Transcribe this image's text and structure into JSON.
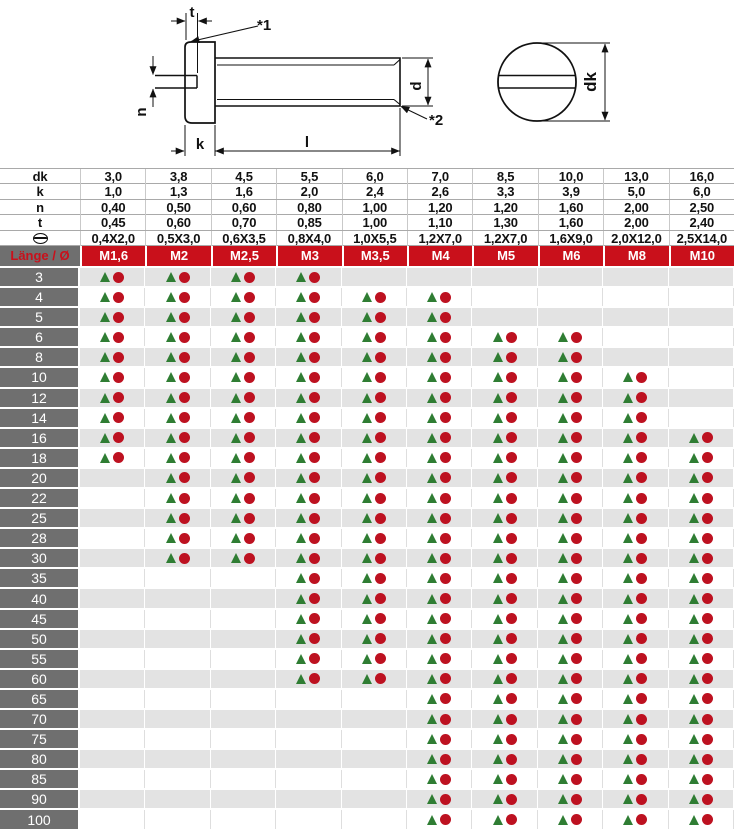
{
  "colors": {
    "header_red": "#c9101b",
    "label_gray": "#6f6f6f",
    "row_gray": "#e3e3e3",
    "triangle_green": "#2f7d33",
    "circle_red": "#bd1120"
  },
  "diagram": {
    "labels": {
      "t": "t",
      "ref1": "*1",
      "n": "n",
      "d": "d",
      "ref2": "*2",
      "k": "k",
      "l": "l",
      "dk": "dk"
    }
  },
  "dims": {
    "rows": [
      {
        "label": "dk",
        "values": [
          "3,0",
          "3,8",
          "4,5",
          "5,5",
          "6,0",
          "7,0",
          "8,5",
          "10,0",
          "13,0",
          "16,0"
        ]
      },
      {
        "label": "k",
        "values": [
          "1,0",
          "1,3",
          "1,6",
          "2,0",
          "2,4",
          "2,6",
          "3,3",
          "3,9",
          "5,0",
          "6,0"
        ]
      },
      {
        "label": "n",
        "values": [
          "0,40",
          "0,50",
          "0,60",
          "0,80",
          "1,00",
          "1,20",
          "1,20",
          "1,60",
          "2,00",
          "2,50"
        ]
      },
      {
        "label": "t",
        "values": [
          "0,45",
          "0,60",
          "0,70",
          "0,85",
          "1,00",
          "1,10",
          "1,30",
          "1,60",
          "2,00",
          "2,40"
        ]
      },
      {
        "label": "⊖",
        "icon": "slot-drive-icon",
        "values": [
          "0,4X2,0",
          "0,5X3,0",
          "0,6X3,5",
          "0,8X4,0",
          "1,0X5,5",
          "1,2X7,0",
          "1,2X7,0",
          "1,6X9,0",
          "2,0X12,0",
          "2,5X14,0"
        ]
      }
    ]
  },
  "table": {
    "corner": "Länge / Ø",
    "columns": [
      "M1,6",
      "M2",
      "M2,5",
      "M3",
      "M3,5",
      "M4",
      "M5",
      "M6",
      "M8",
      "M10"
    ],
    "marker_meaning": {
      "triangle": "green-triangle-marker",
      "circle": "red-circle-marker"
    },
    "rows": [
      {
        "length": "3",
        "available": [
          1,
          1,
          1,
          1,
          0,
          0,
          0,
          0,
          0,
          0
        ]
      },
      {
        "length": "4",
        "available": [
          1,
          1,
          1,
          1,
          1,
          1,
          0,
          0,
          0,
          0
        ]
      },
      {
        "length": "5",
        "available": [
          1,
          1,
          1,
          1,
          1,
          1,
          0,
          0,
          0,
          0
        ]
      },
      {
        "length": "6",
        "available": [
          1,
          1,
          1,
          1,
          1,
          1,
          1,
          1,
          0,
          0
        ]
      },
      {
        "length": "8",
        "available": [
          1,
          1,
          1,
          1,
          1,
          1,
          1,
          1,
          0,
          0
        ]
      },
      {
        "length": "10",
        "available": [
          1,
          1,
          1,
          1,
          1,
          1,
          1,
          1,
          1,
          0
        ]
      },
      {
        "length": "12",
        "available": [
          1,
          1,
          1,
          1,
          1,
          1,
          1,
          1,
          1,
          0
        ]
      },
      {
        "length": "14",
        "available": [
          1,
          1,
          1,
          1,
          1,
          1,
          1,
          1,
          1,
          0
        ]
      },
      {
        "length": "16",
        "available": [
          1,
          1,
          1,
          1,
          1,
          1,
          1,
          1,
          1,
          1
        ]
      },
      {
        "length": "18",
        "available": [
          1,
          1,
          1,
          1,
          1,
          1,
          1,
          1,
          1,
          1
        ]
      },
      {
        "length": "20",
        "available": [
          0,
          1,
          1,
          1,
          1,
          1,
          1,
          1,
          1,
          1
        ]
      },
      {
        "length": "22",
        "available": [
          0,
          1,
          1,
          1,
          1,
          1,
          1,
          1,
          1,
          1
        ]
      },
      {
        "length": "25",
        "available": [
          0,
          1,
          1,
          1,
          1,
          1,
          1,
          1,
          1,
          1
        ]
      },
      {
        "length": "28",
        "available": [
          0,
          1,
          1,
          1,
          1,
          1,
          1,
          1,
          1,
          1
        ]
      },
      {
        "length": "30",
        "available": [
          0,
          1,
          1,
          1,
          1,
          1,
          1,
          1,
          1,
          1
        ]
      },
      {
        "length": "35",
        "available": [
          0,
          0,
          0,
          1,
          1,
          1,
          1,
          1,
          1,
          1
        ]
      },
      {
        "length": "40",
        "available": [
          0,
          0,
          0,
          1,
          1,
          1,
          1,
          1,
          1,
          1
        ]
      },
      {
        "length": "45",
        "available": [
          0,
          0,
          0,
          1,
          1,
          1,
          1,
          1,
          1,
          1
        ]
      },
      {
        "length": "50",
        "available": [
          0,
          0,
          0,
          1,
          1,
          1,
          1,
          1,
          1,
          1
        ]
      },
      {
        "length": "55",
        "available": [
          0,
          0,
          0,
          1,
          1,
          1,
          1,
          1,
          1,
          1
        ]
      },
      {
        "length": "60",
        "available": [
          0,
          0,
          0,
          1,
          1,
          1,
          1,
          1,
          1,
          1
        ]
      },
      {
        "length": "65",
        "available": [
          0,
          0,
          0,
          0,
          0,
          1,
          1,
          1,
          1,
          1
        ]
      },
      {
        "length": "70",
        "available": [
          0,
          0,
          0,
          0,
          0,
          1,
          1,
          1,
          1,
          1
        ]
      },
      {
        "length": "75",
        "available": [
          0,
          0,
          0,
          0,
          0,
          1,
          1,
          1,
          1,
          1
        ]
      },
      {
        "length": "80",
        "available": [
          0,
          0,
          0,
          0,
          0,
          1,
          1,
          1,
          1,
          1
        ]
      },
      {
        "length": "85",
        "available": [
          0,
          0,
          0,
          0,
          0,
          1,
          1,
          1,
          1,
          1
        ]
      },
      {
        "length": "90",
        "available": [
          0,
          0,
          0,
          0,
          0,
          1,
          1,
          1,
          1,
          1
        ]
      },
      {
        "length": "100",
        "available": [
          0,
          0,
          0,
          0,
          0,
          1,
          1,
          1,
          1,
          1
        ]
      }
    ]
  }
}
